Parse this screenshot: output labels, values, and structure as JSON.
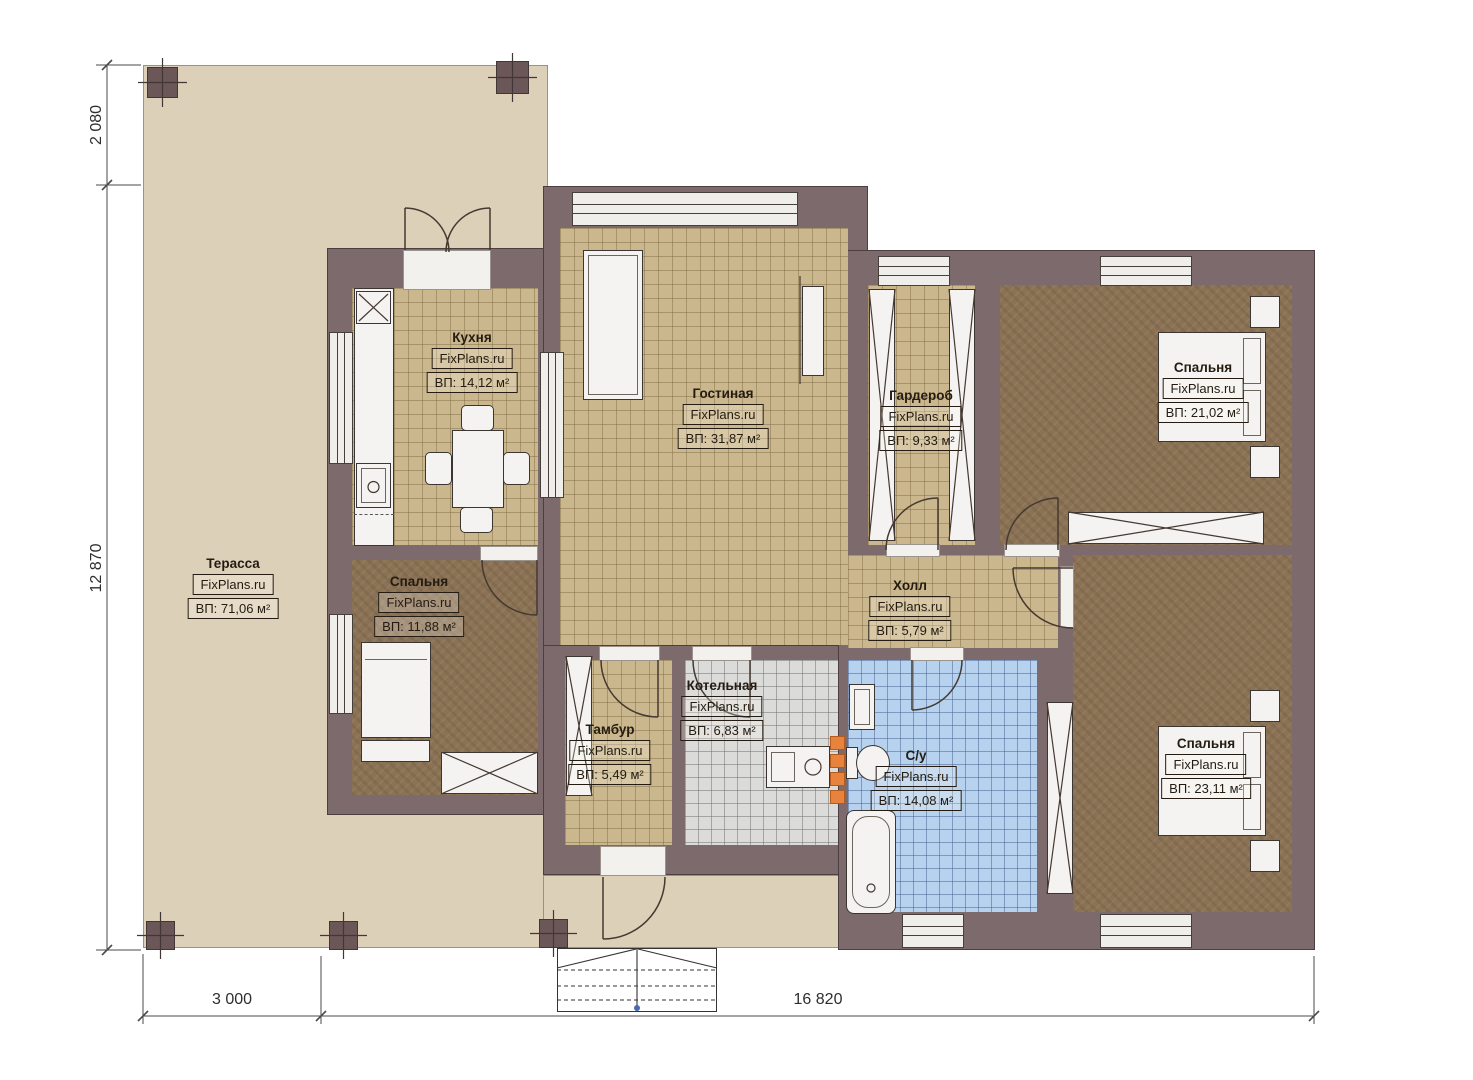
{
  "plan": {
    "rooms": {
      "terrace": {
        "name": "Терасса",
        "watermark": "FixPlans.ru",
        "area": "ВП: 71,06 м²"
      },
      "kitchen": {
        "name": "Кухня",
        "watermark": "FixPlans.ru",
        "area": "ВП: 14,12 м²"
      },
      "living": {
        "name": "Гостиная",
        "watermark": "FixPlans.ru",
        "area": "ВП: 31,87 м²"
      },
      "wardrobe": {
        "name": "Гардероб",
        "watermark": "FixPlans.ru",
        "area": "ВП: 9,33 м²"
      },
      "bedroom_top_right": {
        "name": "Спальня",
        "watermark": "FixPlans.ru",
        "area": "ВП: 21,02 м²"
      },
      "bedroom_left": {
        "name": "Спальня",
        "watermark": "FixPlans.ru",
        "area": "ВП: 11,88 м²"
      },
      "hall": {
        "name": "Холл",
        "watermark": "FixPlans.ru",
        "area": "ВП: 5,79 м²"
      },
      "vestibule": {
        "name": "Тамбур",
        "watermark": "FixPlans.ru",
        "area": "ВП: 5,49 м²"
      },
      "boiler": {
        "name": "Котельная",
        "watermark": "FixPlans.ru",
        "area": "ВП: 6,83 м²"
      },
      "bathroom": {
        "name": "С/у",
        "watermark": "FixPlans.ru",
        "area": "ВП: 14,08 м²"
      },
      "bedroom_bottom_right": {
        "name": "Спальня",
        "watermark": "FixPlans.ru",
        "area": "ВП: 23,11 м²"
      }
    },
    "dimensions": {
      "terrace_depth": "2 080",
      "house_depth": "12 870",
      "terrace_width": "3 000",
      "house_width": "16 820"
    },
    "colors": {
      "wall": "#7d6a6c",
      "terrace": "#ddd0b9",
      "tile_tan": "#cbb78d",
      "carpet": "#8b7254",
      "boiler_tile": "#dbdbd9",
      "bath_tile": "#b7d2ee",
      "chimney_accent": "#e8833e"
    }
  }
}
